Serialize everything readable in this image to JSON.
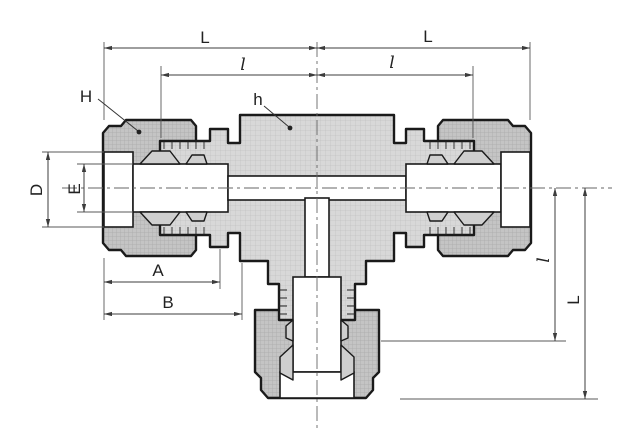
{
  "labels": {
    "L_top_left": "L",
    "l_top_left": "l",
    "L_top_right": "L",
    "l_top_right": "l",
    "H": "H",
    "h": "h",
    "D": "D",
    "E": "E",
    "A": "A",
    "B": "B",
    "l_right": "l",
    "L_right": "L"
  },
  "colors": {
    "background": "#ffffff",
    "body_fill": "#d8d8d8",
    "nut_fill": "#c4c4c4",
    "outline": "#1a1a1a",
    "dimension_lines": "#3c3c3c",
    "centerline": "#666666"
  }
}
